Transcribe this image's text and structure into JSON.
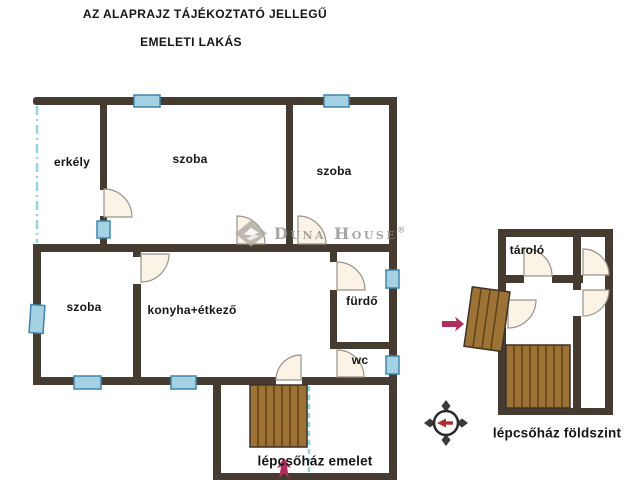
{
  "header": {
    "title": "AZ ALAPRAJZ TÁJÉKOZTATÓ JELLEGŰ",
    "subtitle": "EMELETI LAKÁS"
  },
  "watermark": {
    "brand": "Duna House",
    "registered": "®"
  },
  "upper_floor": {
    "balcony": "erkély",
    "room_top_middle": "szoba",
    "room_top_right": "szoba",
    "room_bottom_left": "szoba",
    "kitchen_dining": "konyha+étkező",
    "bathroom": "fürdő",
    "toilet": "wc",
    "staircase_label": "lépcsőház emelet"
  },
  "ground_floor": {
    "storage": "tároló",
    "staircase_label": "lépcsőház földszint"
  },
  "colors": {
    "wall": "#463b31",
    "window_fill": "#a5d2e2",
    "window_border": "#3f85ad",
    "stairs_fill": "#9c7334",
    "stairs_stripe": "#5e4019",
    "door_fill": "#faf3e6",
    "balcony_line": "#8ed7da",
    "entrance_arrow": "#b02d5d",
    "compass_needle": "#b03030",
    "watermark_gray": "#8f8b86"
  }
}
